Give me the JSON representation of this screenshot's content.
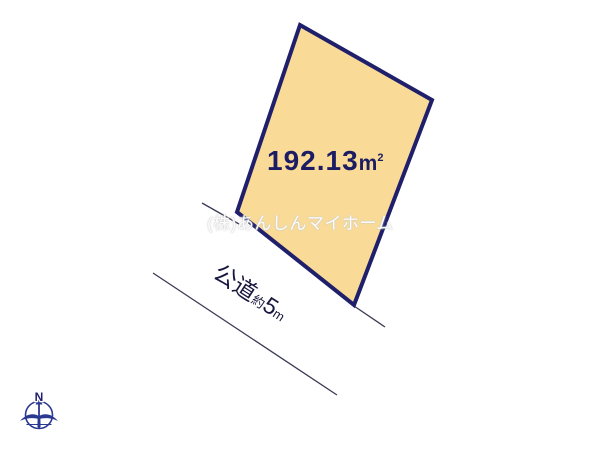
{
  "page": {
    "background": "#ffffff"
  },
  "plot": {
    "area_label": "192.13㎡",
    "area_value": "192.13",
    "area_unit_base": "m",
    "area_unit_exponent": "2",
    "fill_color": "#F9DB97",
    "border_color": "#1F1F6B"
  },
  "road": {
    "label_full": "公道約5m",
    "name": "公道",
    "approx_prefix": "約",
    "width_value": "5",
    "width_unit": "m",
    "line_color": "#3B3B55"
  },
  "watermark": {
    "text": "(株)あんしんマイホーム"
  },
  "compass": {
    "n_label": "N",
    "color": "#2B3990"
  }
}
